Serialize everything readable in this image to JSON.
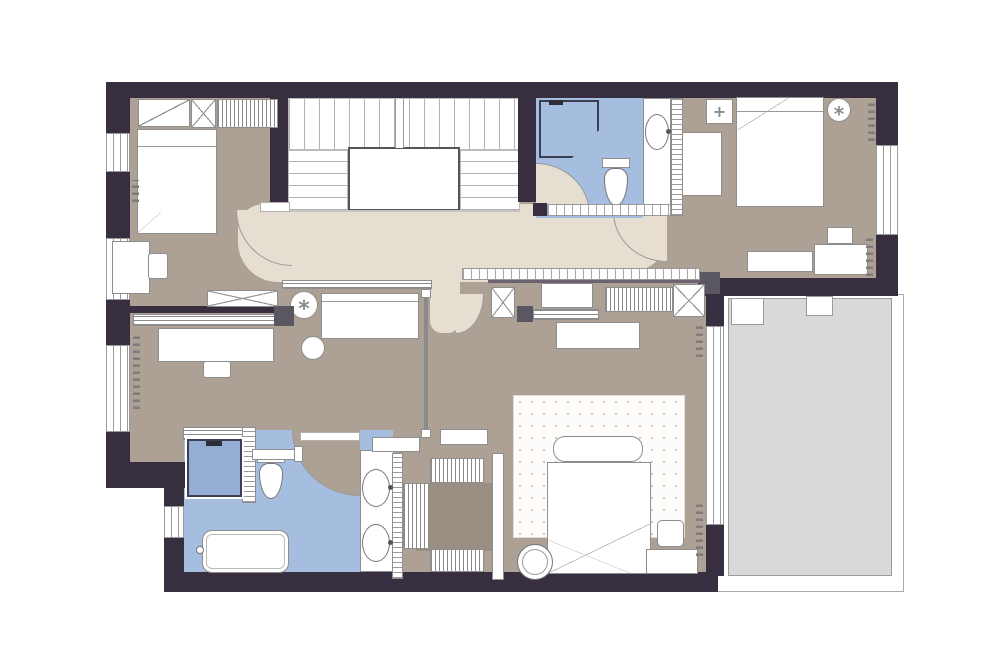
{
  "palette": {
    "background": "#ffffff",
    "wall": "#372e3f",
    "floor": "#ada094",
    "floor_dark": "#9a8d81",
    "hall": "#e6dfd1",
    "bath": "#a5bdde",
    "shower": "#93add3",
    "balcony": "#d9d9db",
    "furniture": "#ffffff",
    "outline": "#8e8e8e",
    "column": "#5b5761",
    "stair_line": "#b3b3b3",
    "rug_dot": "#cfc8bd"
  },
  "icons": {
    "plant_glyph": "*",
    "ceiling_lamp_glyph": "+",
    "table_lamp_glyph": "*"
  }
}
